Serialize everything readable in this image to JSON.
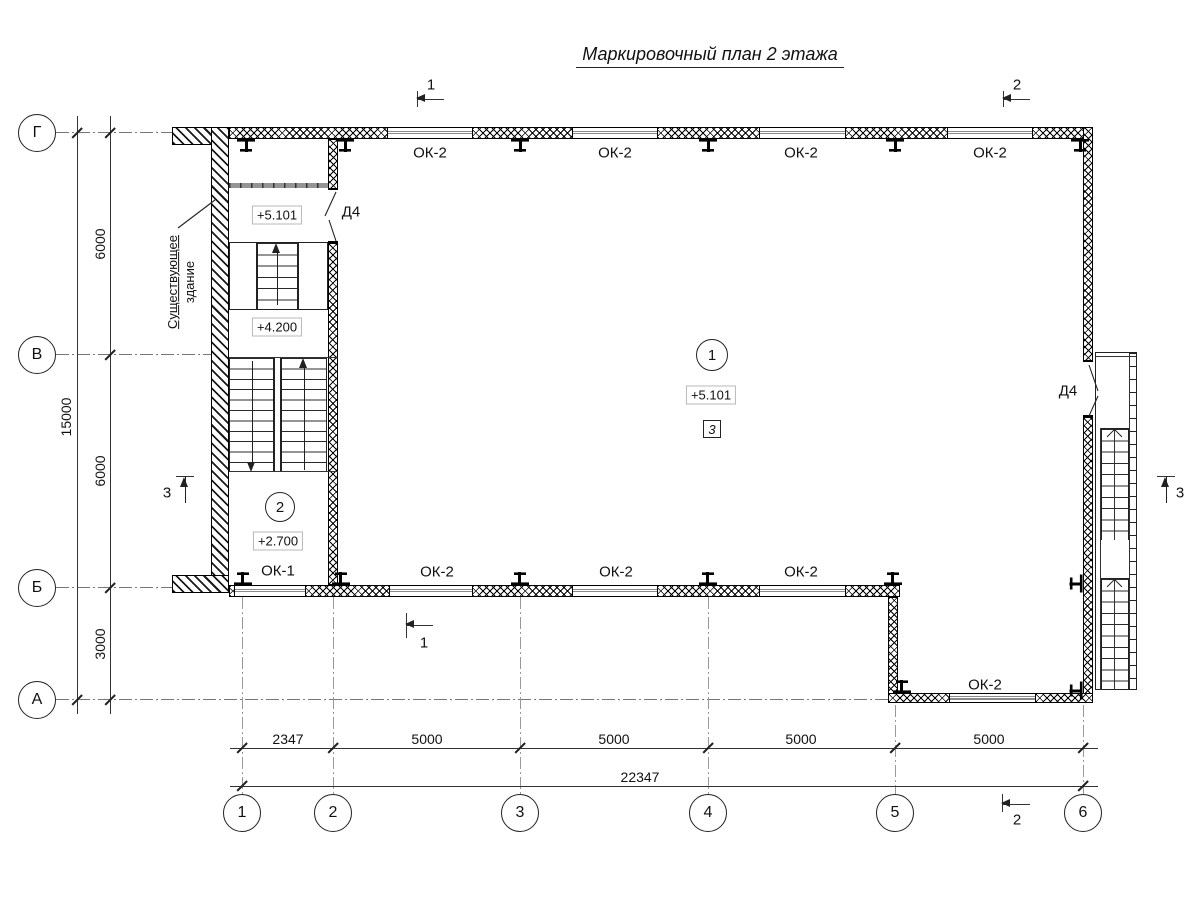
{
  "title": "Маркировочный план 2 этажа",
  "grid": {
    "row_axes": [
      "Г",
      "В",
      "Б",
      "А"
    ],
    "col_axes": [
      "1",
      "2",
      "3",
      "4",
      "5",
      "6"
    ]
  },
  "dims": {
    "v_segments": [
      "6000",
      "6000",
      "3000"
    ],
    "v_total": "15000",
    "h_segments": [
      "2347",
      "5000",
      "5000",
      "5000",
      "5000"
    ],
    "h_total": "22347"
  },
  "windows": {
    "top": [
      "ОК-2",
      "ОК-2",
      "ОК-2",
      "ОК-2"
    ],
    "bottom": [
      "ОК-2",
      "ОК-2",
      "ОК-2"
    ],
    "left": "ОК-1",
    "annex": "ОК-2"
  },
  "doors": {
    "stairwell": "Д4",
    "exit": "Д4"
  },
  "rooms": {
    "hall": {
      "number": "1",
      "elevation": "+5.101",
      "floor_mark": "3"
    },
    "stair": {
      "number": "2",
      "elevation": "+2.700"
    }
  },
  "stairwell": {
    "upper_elevation": "+5.101",
    "mid_elevation": "+4.200"
  },
  "note": {
    "line1": "Существующее",
    "line2": "здание"
  },
  "sections": {
    "s1": "1",
    "s2": "2",
    "s3": "3"
  }
}
